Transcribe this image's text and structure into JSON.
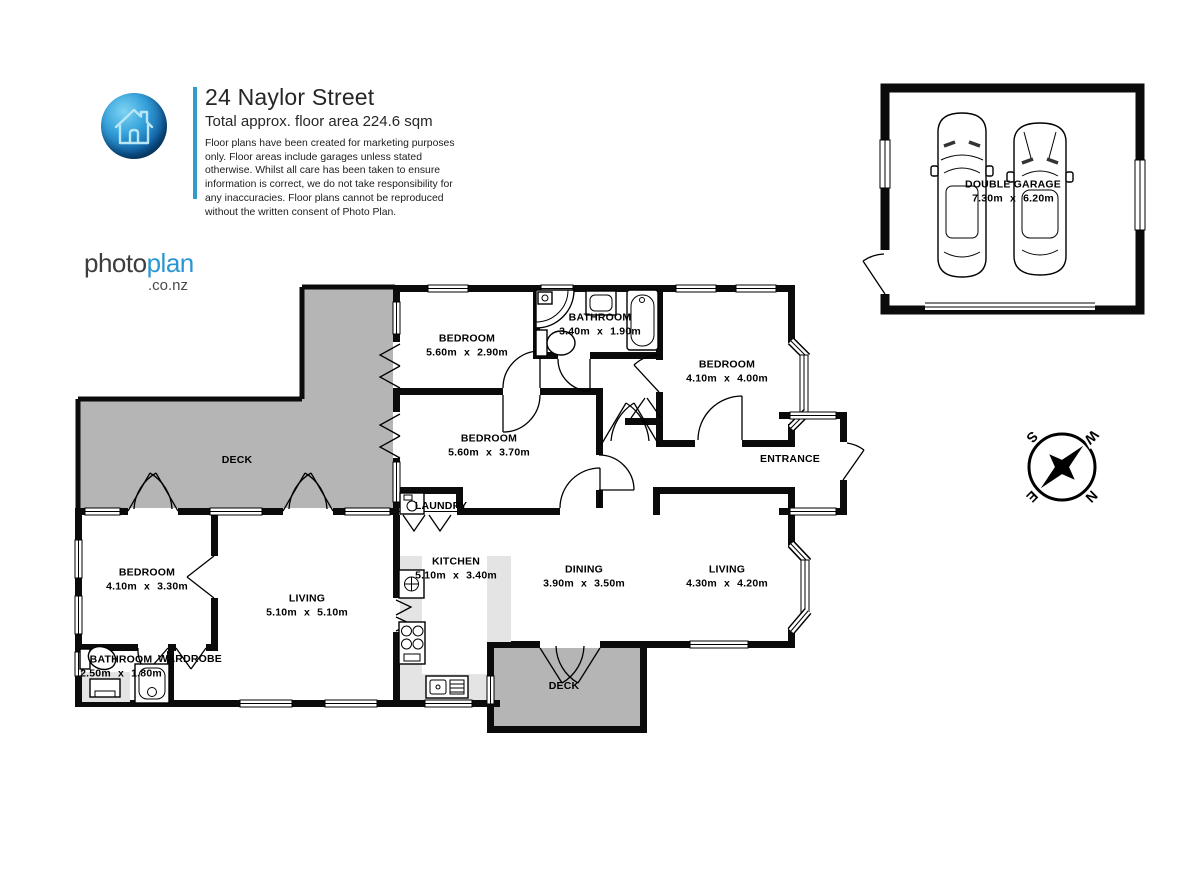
{
  "header": {
    "title": "24 Naylor Street",
    "subtitle": "Total approx. floor area 224.6 sqm",
    "disclaimer": "Floor plans have been created for marketing purposes only. Floor areas include garages unless stated otherwise. Whilst all care has been taken to ensure information is correct, we do not take responsibility for any inaccuracies. Floor plans cannot be reproduced without the written consent of Photo Plan.",
    "brand": {
      "photo": "photo",
      "plan": "plan",
      "suffix": ".co.nz"
    }
  },
  "colors": {
    "wall": "#0b0b0b",
    "deck_fill": "#b5b5b5",
    "counter_fill": "#e4e4e4",
    "brand_blue": "#2a97d4",
    "divider_teal": "#2f9cc9"
  },
  "compass": {
    "n": "N",
    "e": "E",
    "s": "S",
    "w": "W"
  },
  "rooms": {
    "bedroom1": {
      "name": "BEDROOM",
      "dims": "5.60m x 2.90m"
    },
    "bathroom1": {
      "name": "BATHROOM",
      "dims": "3.40m x 1.90m"
    },
    "bedroom2": {
      "name": "BEDROOM",
      "dims": "4.10m x 4.00m"
    },
    "bedroom3": {
      "name": "BEDROOM",
      "dims": "5.60m x 3.70m"
    },
    "entrance": {
      "name": "ENTRANCE"
    },
    "deck_upper": {
      "name": "DECK"
    },
    "laundry": {
      "name": "LAUNDRY"
    },
    "bedroom4": {
      "name": "BEDROOM",
      "dims": "4.10m x 3.30m"
    },
    "living1": {
      "name": "LIVING",
      "dims": "5.10m x 5.10m"
    },
    "kitchen": {
      "name": "KITCHEN",
      "dims": "5.10m x 3.40m"
    },
    "dining": {
      "name": "DINING",
      "dims": "3.90m x 3.50m"
    },
    "living2": {
      "name": "LIVING",
      "dims": "4.30m x 4.20m"
    },
    "bathroom2": {
      "name": "BATHROOM",
      "dims": "2.50m x 1.80m"
    },
    "wardrobe": {
      "name": "WARDROBE"
    },
    "deck_lower": {
      "name": "DECK"
    },
    "garage": {
      "name": "DOUBLE GARAGE",
      "dims": "7.30m x 6.20m"
    }
  }
}
